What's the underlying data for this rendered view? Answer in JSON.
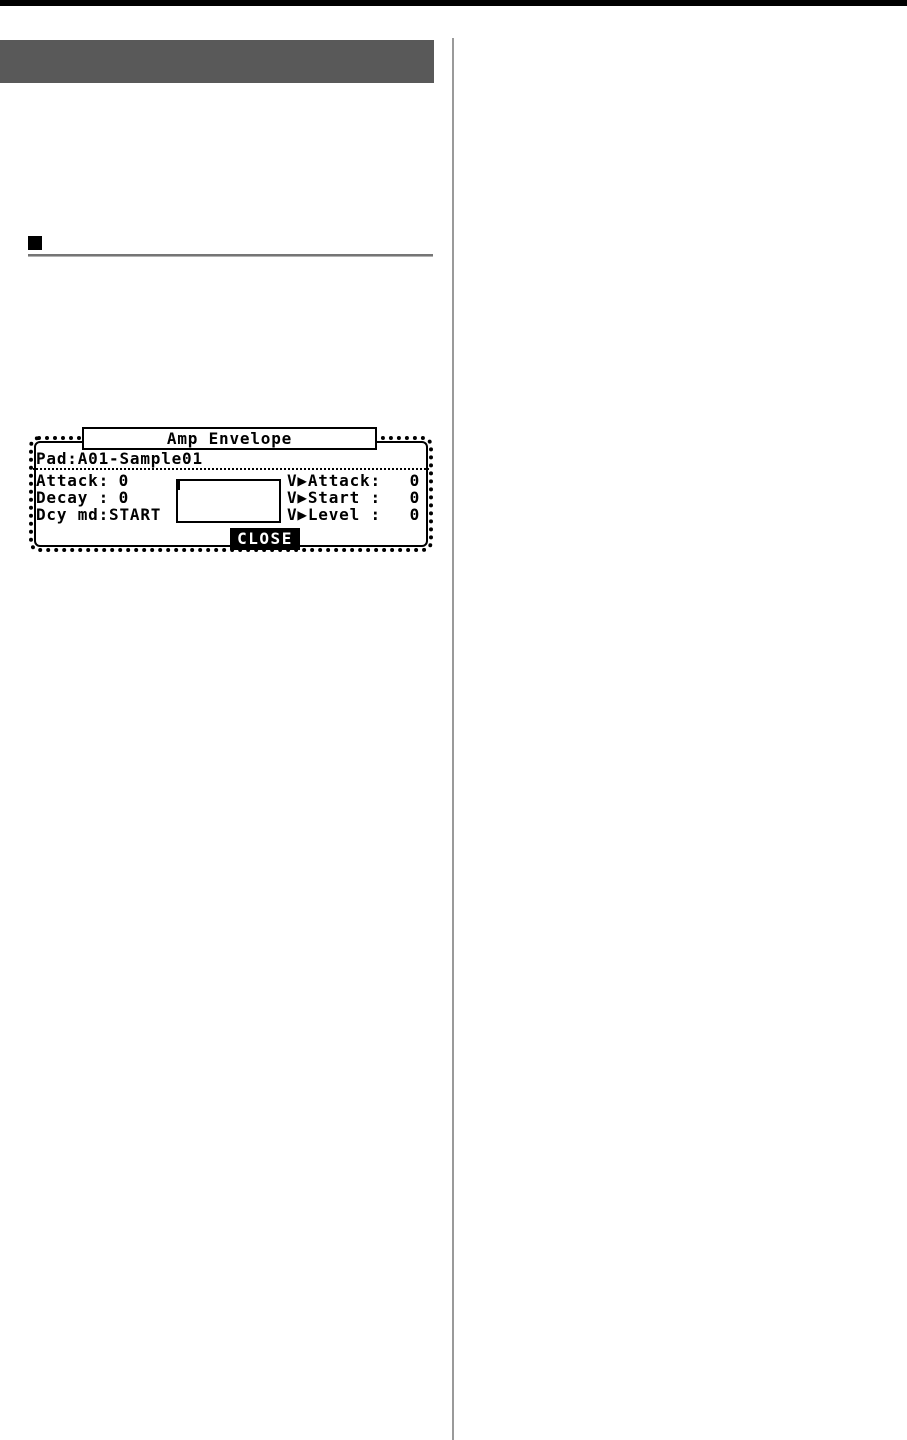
{
  "page": {
    "top_bar_color": "#000000",
    "chapter_band_color": "#595959",
    "divider_color": "#9a9a9a",
    "rule_color": "#757575",
    "lcd_foreground": "#000000",
    "lcd_background": "#ffffff"
  },
  "lcd_dialog": {
    "title": "Amp Envelope",
    "pad_label": "Pad:",
    "pad_value": "A01-Sample01",
    "left_params": [
      {
        "label": "Attack:",
        "value": "0"
      },
      {
        "label": "Decay :",
        "value": "0"
      },
      {
        "label": "Dcy md:",
        "value": "START"
      }
    ],
    "right_params": [
      {
        "label": "V▶Attack:",
        "value": "0"
      },
      {
        "label": "V▶Start :",
        "value": "0"
      },
      {
        "label": "V▶Level :",
        "value": "0"
      }
    ],
    "close_label": "CLOSE"
  }
}
